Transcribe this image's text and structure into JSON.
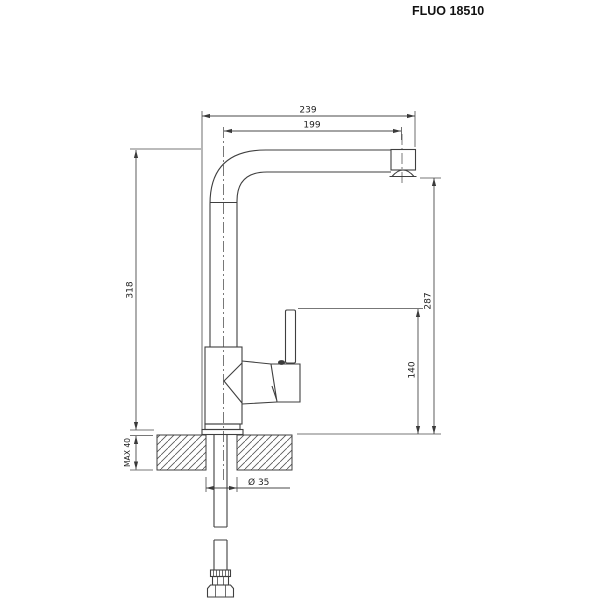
{
  "title": "FLUO 18510",
  "drawing": {
    "type": "technical line drawing",
    "subject": "single-lever kitchen mixer tap, side elevation with installation dimensions",
    "units": "mm",
    "labels": {
      "d239": "239",
      "d199": "199",
      "d318": "318",
      "d287": "287",
      "d140": "140",
      "max40": "MAX 40",
      "dia35": "Ø 35"
    },
    "colors": {
      "line": "#3f3f3f",
      "dimension_line": "#4a4a4a",
      "text": "#1d1d1d",
      "background": "#ffffff"
    }
  }
}
